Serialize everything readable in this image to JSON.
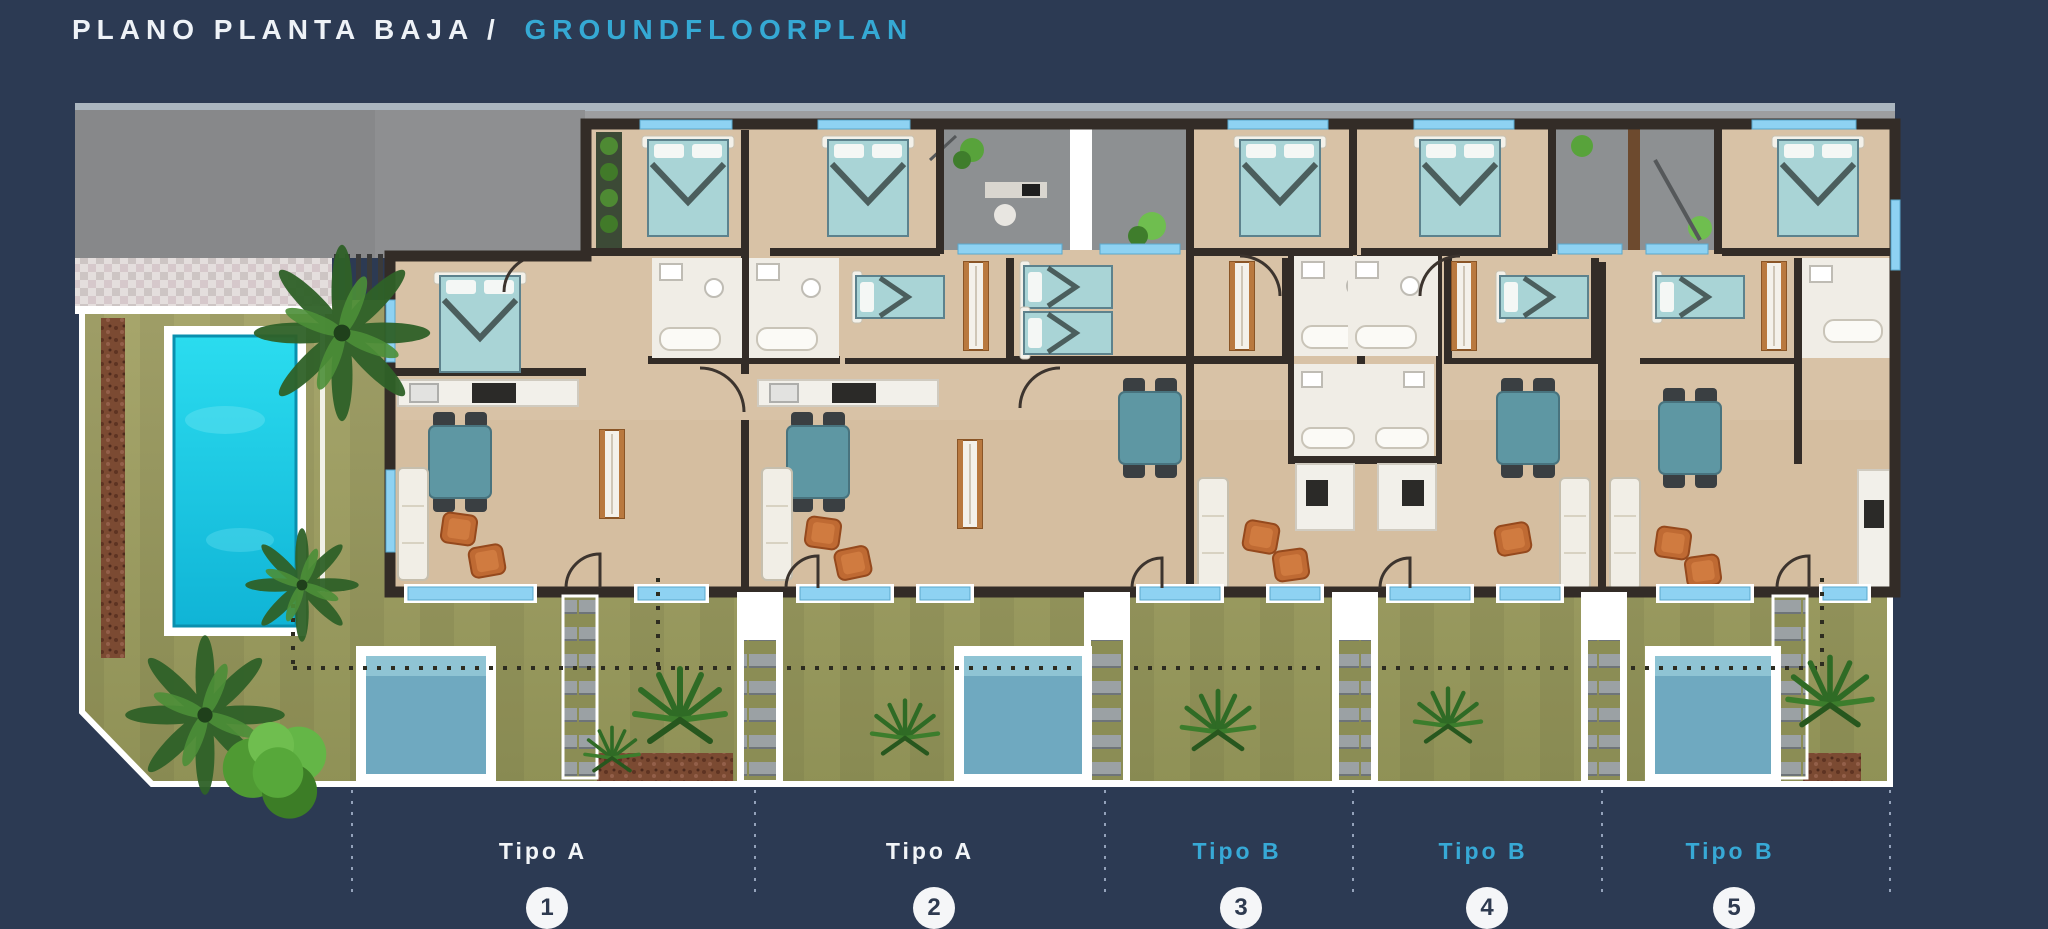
{
  "title": {
    "part1": "PLANO PLANTA BAJA /",
    "part2": "GROUNDFLOORPLAN"
  },
  "units": [
    {
      "label": "Tipo A",
      "number": "1",
      "type": "A",
      "label_color": "#f2f5f8"
    },
    {
      "label": "Tipo A",
      "number": "2",
      "type": "A",
      "label_color": "#f2f5f8"
    },
    {
      "label": "Tipo B",
      "number": "3",
      "type": "B",
      "label_color": "#37a9d6"
    },
    {
      "label": "Tipo B",
      "number": "4",
      "type": "B",
      "label_color": "#37a9d6"
    },
    {
      "label": "Tipo B",
      "number": "5",
      "type": "B",
      "label_color": "#37a9d6"
    }
  ],
  "palette": {
    "background_navy": "#2c3a53",
    "accent_cyan": "#35a9d4",
    "label_white": "#f2f5f8",
    "wall_dark": "#332c27",
    "floor_tan": "#d8c2a6",
    "window_blue": "#8ed2f2",
    "bed_teal": "#a9d4d6",
    "lawn_olive": "#a2a164",
    "main_pool_turquoise": "#1fd2ea",
    "plunge_pool_blue": "#6fa9c0",
    "patio_gray": "#8d9092",
    "street_gray": "#8e8f91",
    "armchair_orange": "#bf6a33",
    "dining_table_teal": "#5e97a3"
  },
  "icons": {
    "palm": "palm-tree-icon",
    "shrub": "shrub-icon",
    "grass": "grass-tuft-icon",
    "stairs": "stairs-icon",
    "bed": "double-bed-icon",
    "sofa": "sofa-icon",
    "dining": "dining-table-icon",
    "pool": "pool-icon"
  }
}
